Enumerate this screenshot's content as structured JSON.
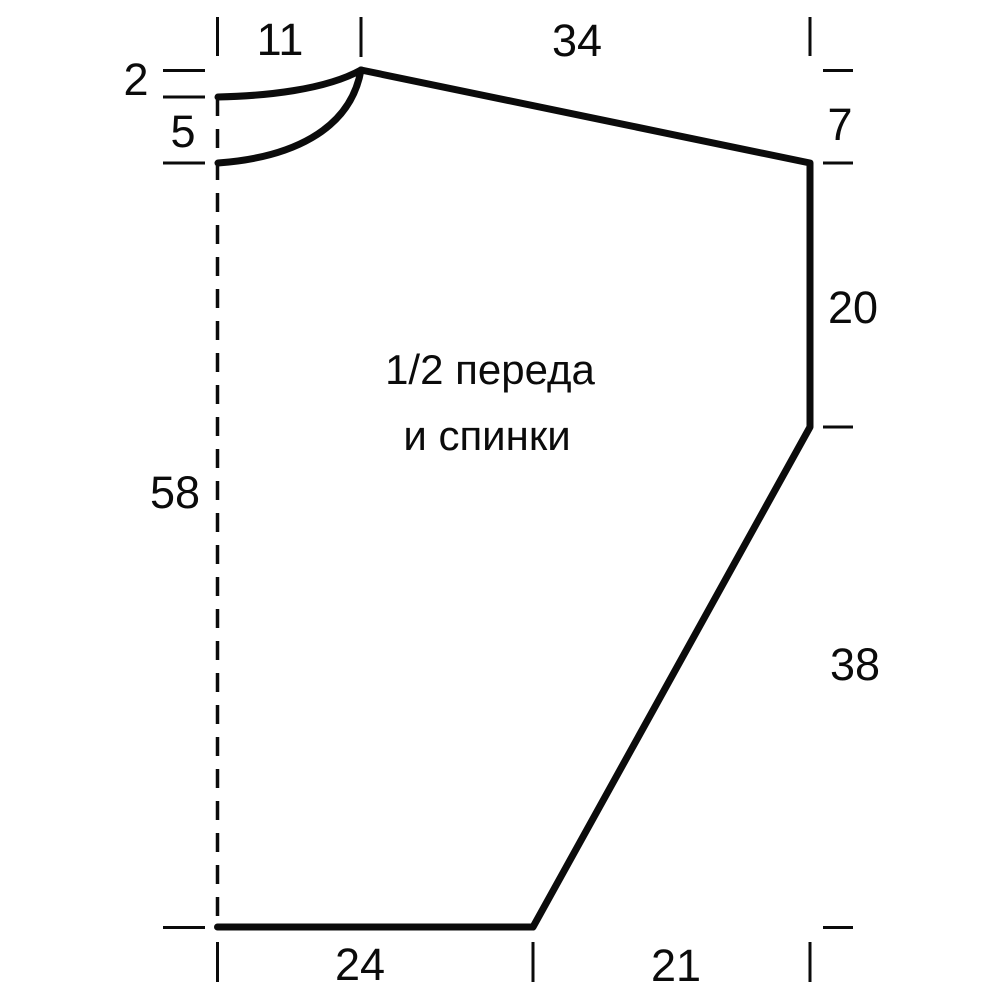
{
  "diagram": {
    "type": "knitting-pattern-schematic",
    "colors": {
      "ink": "#0b0b0b",
      "background": "#ffffff"
    },
    "piece_label": {
      "line1": "1/2 переда",
      "line2": "и спинки"
    },
    "measurements_cm": {
      "neck_width_top": "11",
      "shoulder_line_top": "34",
      "back_neck_depth_left": "2",
      "front_neck_depth_left": "5",
      "total_length_left": "58",
      "shoulder_drop_right": "7",
      "armhole_straight_right": "20",
      "side_slope_right": "38",
      "hem_width_bottom": "24",
      "hem_to_side_bottom": "21"
    }
  }
}
